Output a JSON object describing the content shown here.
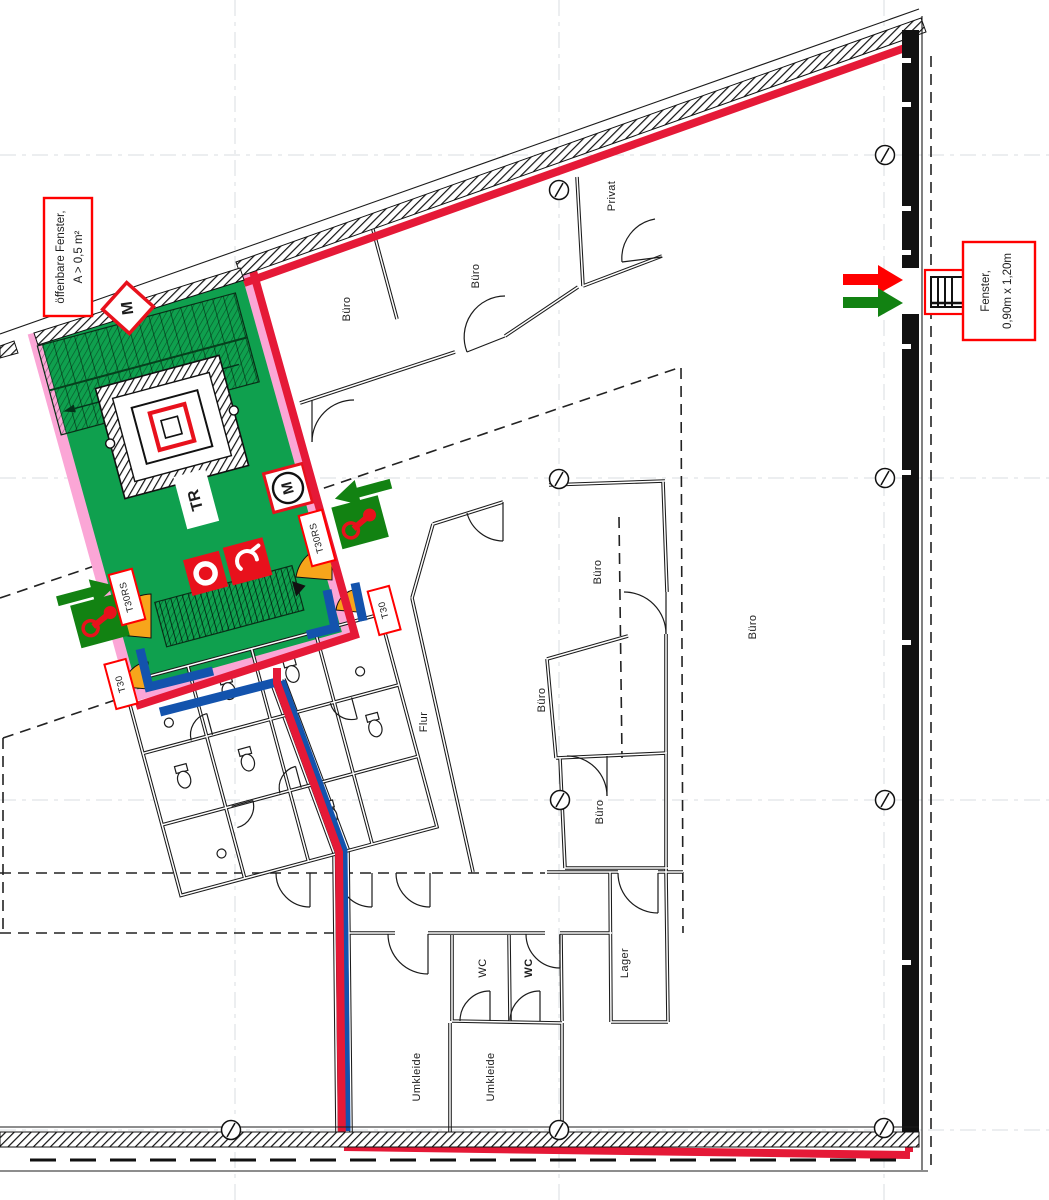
{
  "drawing": {
    "kind": "fire-safety floor plan (Brandschutz / Fluchtwegeplan)",
    "stair_label": "TR"
  },
  "rooms": [
    {
      "label": "Büro"
    },
    {
      "label": "Büro"
    },
    {
      "label": "Privat"
    },
    {
      "label": "Büro"
    },
    {
      "label": "Büro"
    },
    {
      "label": "Büro"
    },
    {
      "label": "Büro"
    },
    {
      "label": "Flur"
    },
    {
      "label": "WC"
    },
    {
      "label": "WC"
    },
    {
      "label": "Lager"
    },
    {
      "label": "Umkleide"
    },
    {
      "label": "Umkleide"
    }
  ],
  "door_tags": [
    {
      "label": "T30RS"
    },
    {
      "label": "T30RS"
    },
    {
      "label": "T30"
    },
    {
      "label": "T30"
    }
  ],
  "symbols": {
    "m_wall": "M",
    "m_circle": "M"
  },
  "annotations": {
    "openable_window": {
      "line1": "öffenbare Fenster,",
      "line2": "A > 0,5 m²"
    },
    "window_size": {
      "line1": "Fenster,",
      "line2": "0,90m x 1,20m"
    }
  },
  "legend_colors": {
    "escape_route_red": "#e51937",
    "stairwell_green": "#0fa04e",
    "fire_wall_pink": "#fba6d6",
    "partition_blue": "#1353ad",
    "door_orange": "#f7a51b",
    "exit_green": "#128212",
    "icon_red": "#e8111c",
    "tag_border_red": "#ff0000"
  }
}
